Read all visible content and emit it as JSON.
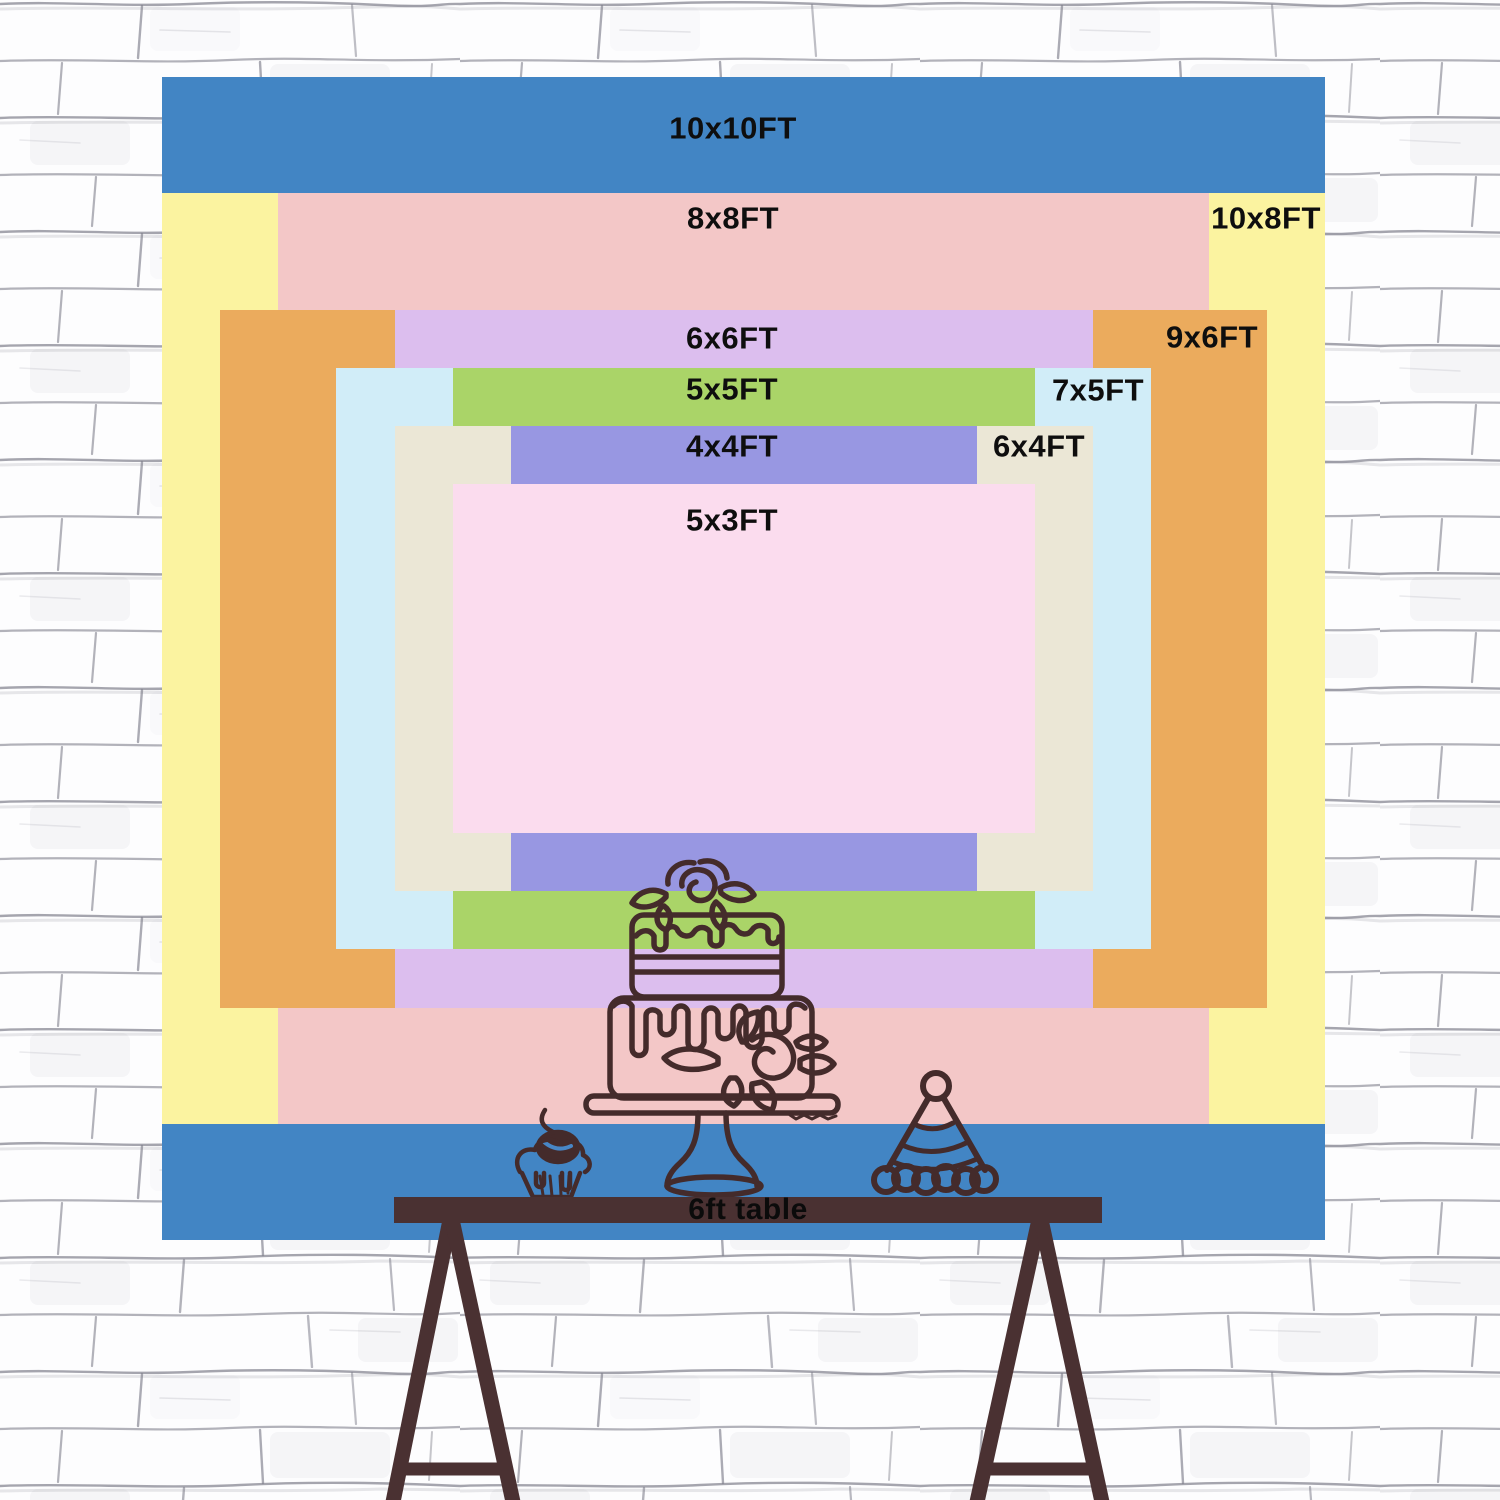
{
  "scene": {
    "type": "backdrop-size-comparison-chart",
    "wall": {
      "brick_color": "#fdfdfe",
      "mortar_color": "#80808c"
    },
    "ink_color": "#442b2b",
    "label_text_color": "#0e0e0e",
    "cherry_highlight_color": "#4886c5"
  },
  "sizes": [
    {
      "id": "10x10",
      "label": "10x10FT",
      "color": "#4285c4",
      "x": 162,
      "y": 77,
      "w": 1163,
      "h": 1163,
      "lx": 733,
      "ly": 128
    },
    {
      "id": "10x8",
      "label": "10x8FT",
      "color": "#fbf3a0",
      "x": 162,
      "y": 193,
      "w": 1163,
      "h": 931,
      "lx": 1266,
      "ly": 218
    },
    {
      "id": "8x8",
      "label": "8x8FT",
      "color": "#f3c7c7",
      "x": 278,
      "y": 193,
      "w": 931,
      "h": 931,
      "lx": 733,
      "ly": 218
    },
    {
      "id": "9x6",
      "label": "9x6FT",
      "color": "#ebab5d",
      "x": 220,
      "y": 310,
      "w": 1047,
      "h": 698,
      "lx": 1212,
      "ly": 337
    },
    {
      "id": "6x6",
      "label": "6x6FT",
      "color": "#dcbeee",
      "x": 395,
      "y": 310,
      "w": 698,
      "h": 698,
      "lx": 732,
      "ly": 338
    },
    {
      "id": "7x5",
      "label": "7x5FT",
      "color": "#d1edf8",
      "x": 336,
      "y": 368,
      "w": 815,
      "h": 581,
      "lx": 1098,
      "ly": 390
    },
    {
      "id": "5x5",
      "label": "5x5FT",
      "color": "#aad468",
      "x": 453,
      "y": 368,
      "w": 582,
      "h": 581,
      "lx": 732,
      "ly": 389
    },
    {
      "id": "6x4",
      "label": "6x4FT",
      "color": "#ebe7d6",
      "x": 395,
      "y": 426,
      "w": 698,
      "h": 465,
      "lx": 1039,
      "ly": 446
    },
    {
      "id": "4x4",
      "label": "4x4FT",
      "color": "#9897e2",
      "x": 511,
      "y": 426,
      "w": 466,
      "h": 465,
      "lx": 732,
      "ly": 446
    },
    {
      "id": "5x3",
      "label": "5x3FT",
      "color": "#fbdcee",
      "x": 453,
      "y": 484,
      "w": 582,
      "h": 349,
      "lx": 732,
      "ly": 520
    }
  ],
  "table": {
    "label": "6ft table",
    "x": 394,
    "y": 1197,
    "w": 708,
    "h": 26,
    "bar_color": "#4a3132",
    "leg_color": "#4a3132",
    "label_color": "#0b0b0b"
  },
  "illustrations": [
    {
      "id": "tiered-cake-illustration"
    },
    {
      "id": "cupcake-illustration"
    },
    {
      "id": "party-hat-illustration"
    }
  ]
}
